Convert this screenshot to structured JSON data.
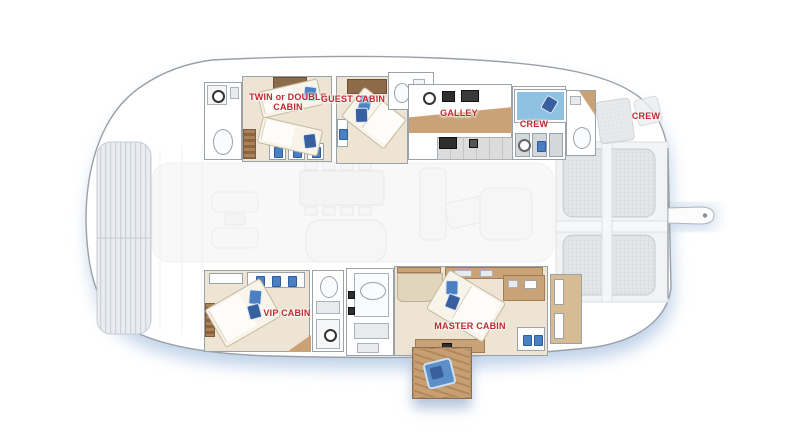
{
  "plan": {
    "type": "catamaran-deck-plan",
    "labels": {
      "twin_cabin": "TWIN or DOUBLE CABIN",
      "guest_cabin": "GUEST CABIN",
      "galley": "GALLEY",
      "crew_cabin": "CREW",
      "crew_aft": "CREW",
      "vip_cabin": "VIP CABIN",
      "master_cabin": "MASTER CABIN"
    },
    "colors": {
      "label_red": "#c1272d",
      "wood_dark": "#8b6b4a",
      "wood_tan": "#c9a277",
      "floor_beige": "#ede4d4",
      "pillow_blue": "#4a7fc1",
      "bunk_blue": "#8fc1e3",
      "shadow_blue": "#b9cde6",
      "hull_outline": "#9aa0a6"
    },
    "icons": {
      "toilet": "css-ellipse",
      "sink": "css-rect",
      "shower_head": "css-ring",
      "stove_burner": "css-ring",
      "pillow": "css-rounded-rect",
      "trampoline_net": "svg-line-pattern",
      "sunpad_grid": "svg-grid-pattern",
      "gangway": "svg-shape"
    }
  }
}
